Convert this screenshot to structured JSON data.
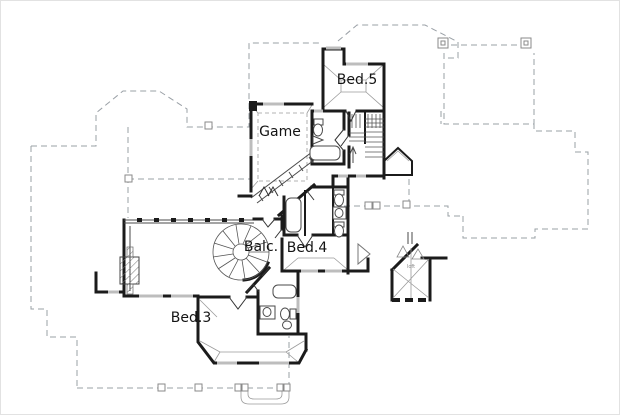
{
  "meta": {
    "kind": "floor-plan",
    "floor": "second-floor"
  },
  "rooms": [
    {
      "id": "bed5",
      "label": "Bed.5"
    },
    {
      "id": "game",
      "label": "Game"
    },
    {
      "id": "balc",
      "label": "Balc."
    },
    {
      "id": "bed4",
      "label": "Bed.4"
    },
    {
      "id": "bed3",
      "label": "Bed.3"
    },
    {
      "id": "loft",
      "label": "loft"
    }
  ],
  "colors": {
    "wall": "#1b1b1b",
    "lower_floor_dashed": "#9aa0a6",
    "window": "#bdbdbd",
    "fixture": "#4a4a4a",
    "background": "#ffffff"
  }
}
